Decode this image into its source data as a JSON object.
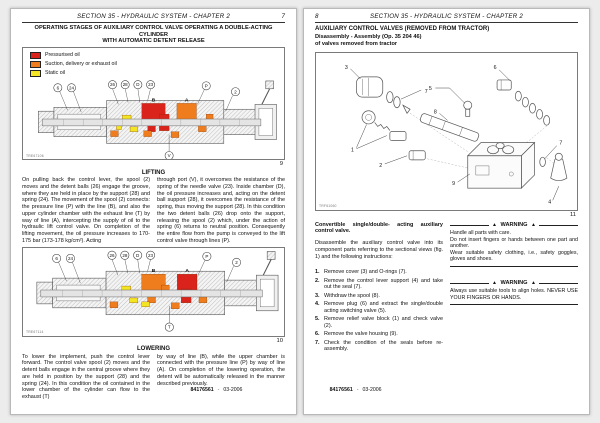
{
  "colors": {
    "pressurised": "#d9231b",
    "suction": "#ef7d1d",
    "static": "#f4e524"
  },
  "left_page": {
    "header": {
      "title": "SECTION 35 - HYDRAULIC SYSTEM - CHAPTER 2",
      "page_number": "7"
    },
    "title_line1": "OPERATING STAGES OF AUXILIARY CONTROL VALVE OPERATING A DOUBLE-ACTING CYLINDER",
    "title_line2": "WITH AUTOMATIC DETENT RELEASE",
    "legend": [
      {
        "label": "Pressurised oil"
      },
      {
        "label": "Suction, delivery or exhaust oil"
      },
      {
        "label": "Static oil"
      }
    ],
    "figure9": {
      "ref": "TRE67106",
      "number": "9",
      "callouts": [
        "6",
        "24",
        "26",
        "28",
        "D",
        "23",
        "P",
        "B",
        "A",
        "2",
        "V"
      ],
      "port_b_color": "#d9231b",
      "port_a_color": "#ef7d1d"
    },
    "lifting": {
      "heading": "LIFTING",
      "col1": "On pulling back the control lever, the spool (2) moves and the detent balls (26) engage the groove, where they are held in place by the support (28) and spring (24). The movement of the spool (2) connects: the pressure line (P) with the line (B), and also the upper cylinder chamber with the exhaust line (T) by way of line (A), intercepting the supply of oil to the hydraulic lift control valve. On completion of the lifting movement, the oil pressure increases to 170-175 bar (173-178 kg/cm²). Acting",
      "col2": "through port (V), it overcomes the resistance of the spring of the needle valve (23). Inside chamber (D), the oil pressure increases and, acting on the detent ball support (28), it overcomes the resistance of the spring, thus moving the support (28). In this condition the two detent balls (26) drop onto the support, releasing the spool (2) which, under the action of spring (6) returns to neutral position. Consequently the entire flow from the pump is conveyed to the lift control valve through lines (P)."
    },
    "figure10": {
      "ref": "TRE67114",
      "number": "10",
      "callouts": [
        "6",
        "24",
        "26",
        "28",
        "D",
        "23",
        "P",
        "B",
        "A",
        "2",
        "T"
      ],
      "port_b_color": "#ef7d1d",
      "port_a_color": "#d9231b"
    },
    "lowering": {
      "heading": "LOWERING",
      "col1": "To lower the implement, push the control lever forward. The control valve spool (2) moves and the detent balls engage in the central groove where they are held in position by the support (28) and the spring (24). In this condition the oil contained in the lower chamber of the cylinder can flow to the exhaust (T)",
      "col2": "by way of line (B), while the upper chamber is connected with the pressure line (P) by way of line (A). On completion of the lowering operation, the detent will be automatically released in the manner described previously."
    },
    "footer": {
      "code": "84176561",
      "date": "03-2006"
    }
  },
  "right_page": {
    "header": {
      "title": "SECTION 35 - HYDRAULIC SYSTEM - CHAPTER 2",
      "page_number": "8"
    },
    "title": "AUXILIARY CONTROL VALVES (REMOVED FROM TRACTOR)",
    "subtitle_line1": "Disassembly - Assembly (Op. 35 204 46)",
    "subtitle_line2": "of valves removed from tractor",
    "figure11": {
      "ref": "TRF61060",
      "number": "11",
      "callouts": [
        "3",
        "5",
        "6",
        "7",
        "8",
        "1",
        "2",
        "9",
        "7",
        "4"
      ]
    },
    "section_heading": "Convertible single/double- acting auxiliary control valve.",
    "intro": "Disassemble the auxiliary control valve into its component parts referring to the sectional views (fig. 1) and the following instructions:",
    "steps": [
      {
        "n": "1.",
        "text": "Remove cover (3) and O-rings (7)."
      },
      {
        "n": "2.",
        "text": "Remove the control lever support (4) and take out the seal (7)."
      },
      {
        "n": "3.",
        "text": "Withdraw the spool (8)."
      },
      {
        "n": "4.",
        "text": "Remove plug (6) and extract the single/double acting switching valve (5)."
      },
      {
        "n": "5.",
        "text": "Remove relief valve block (1) and check valve (2)."
      },
      {
        "n": "6.",
        "text": "Remove the valve housing (9)."
      },
      {
        "n": "7.",
        "text": "Check the condition of the seals before re-assembly."
      }
    ],
    "warning_icon": "▲",
    "warnings": [
      {
        "title": "WARNING",
        "lines": [
          "Handle all parts with care.",
          "Do not insert fingers or hands between one part and another.",
          "Wear suitable safety clothing, i.e., safety goggles, gloves and shoes."
        ]
      },
      {
        "title": "WARNING",
        "lines": [
          "Always use suitable tools to align holes. NEVER USE YOUR FINGERS OR HANDS."
        ]
      }
    ],
    "footer": {
      "code": "84176561",
      "date": "03-2006"
    }
  }
}
